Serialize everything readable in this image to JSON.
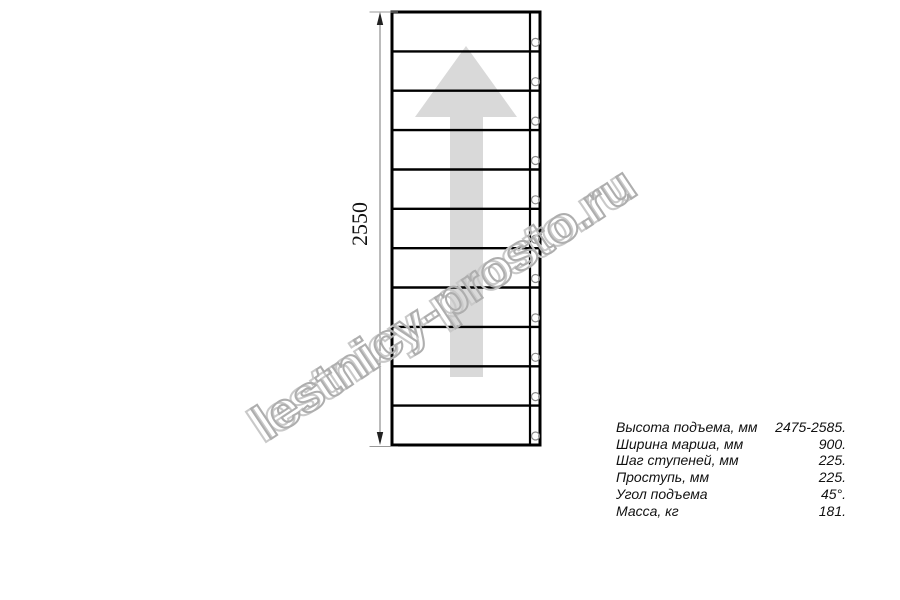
{
  "drawing": {
    "dimension_label": "2550",
    "step_count": 11,
    "bolt_count": 11,
    "colors": {
      "line": "#000000",
      "arrow": "#d9d9d9",
      "dimension": "#777777",
      "extension": "#999999",
      "bolt": "#8a8a8a",
      "text": "#111111"
    }
  },
  "watermark": {
    "text": "lestnicy-prosto.ru",
    "color": "#aeaeae",
    "shadow_color": "#c9c9c9"
  },
  "specs": {
    "rows": [
      {
        "label": "Высота подъема, мм",
        "value": "2475-2585."
      },
      {
        "label": "Ширина марша, мм",
        "value": "900."
      },
      {
        "label": "Шаг ступеней, мм",
        "value": "225."
      },
      {
        "label": "Проступь, мм",
        "value": "225."
      },
      {
        "label": "Угол подъема",
        "value": "45°."
      },
      {
        "label": "Масса, кг",
        "value": "181."
      }
    ]
  }
}
